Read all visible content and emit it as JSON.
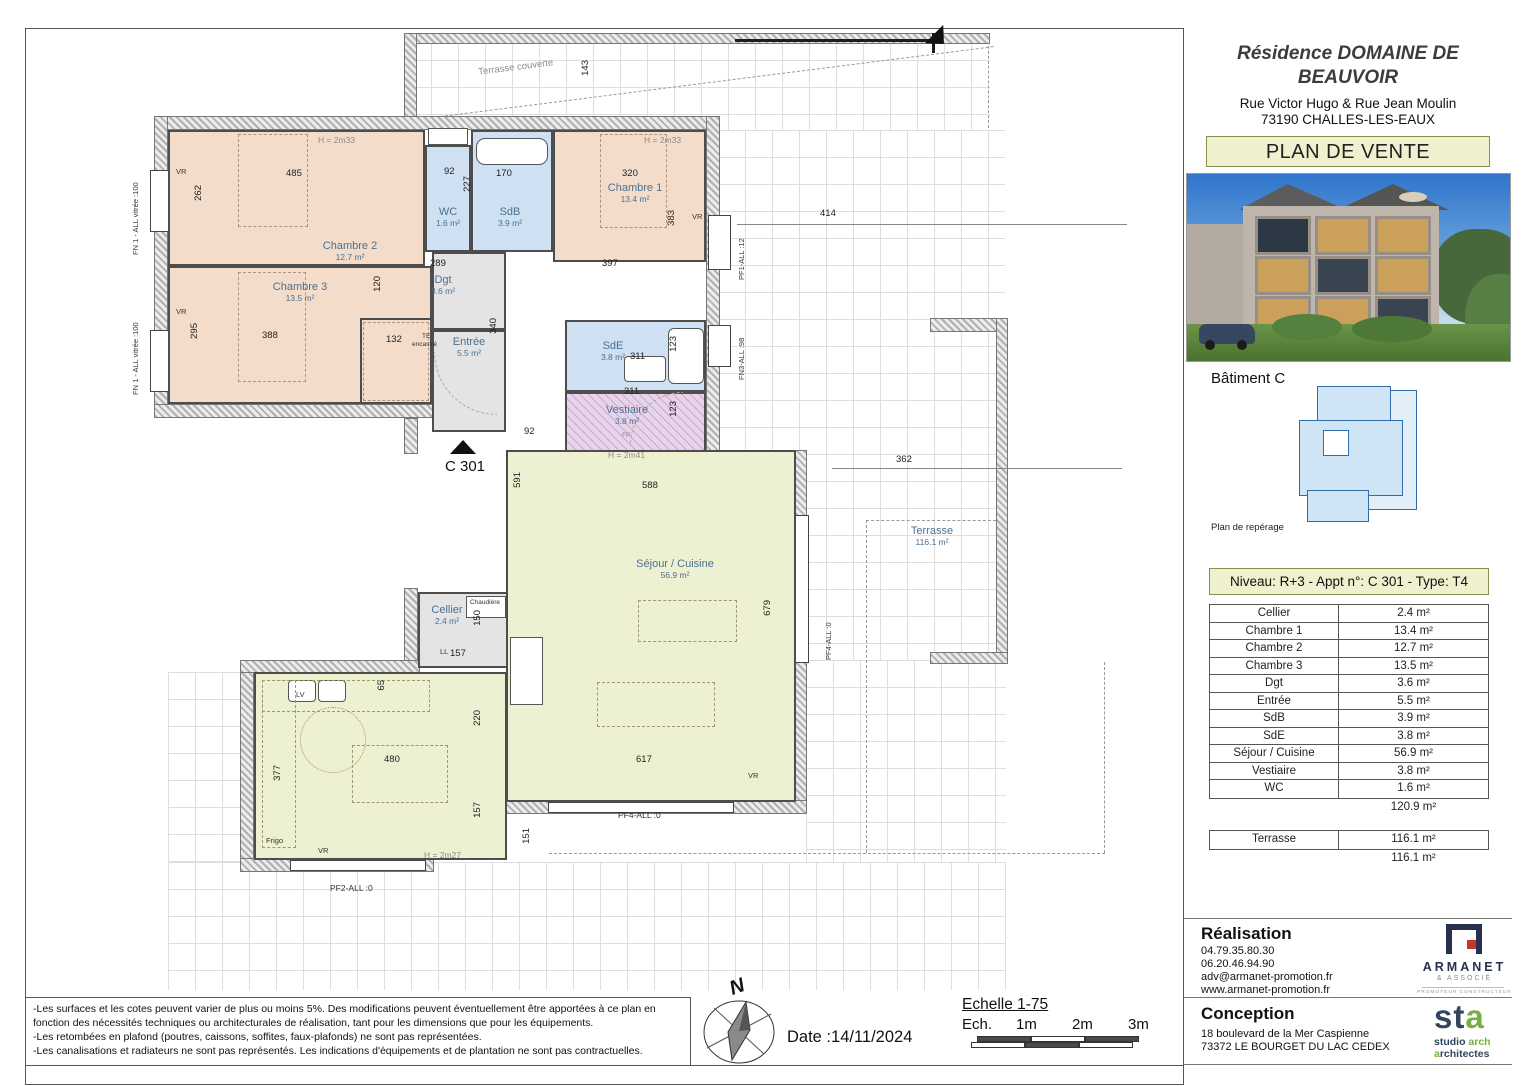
{
  "title_block": {
    "title_line1": "Résidence DOMAINE DE",
    "title_line2": "BEAUVOIR",
    "address_line1": "Rue Victor Hugo & Rue Jean Moulin",
    "address_line2": "73190 CHALLES-LES-EAUX",
    "plan_de_vente": "PLAN DE VENTE"
  },
  "reperage": {
    "batiment": "Bâtiment C",
    "caption": "Plan de repérage"
  },
  "apartment_table": {
    "header": "Niveau: R+3  - Appt n°: C 301 - Type: T4",
    "rows": [
      {
        "label": "Cellier",
        "value": "2.4 m²"
      },
      {
        "label": "Chambre 1",
        "value": "13.4 m²"
      },
      {
        "label": "Chambre 2",
        "value": "12.7 m²"
      },
      {
        "label": "Chambre 3",
        "value": "13.5 m²"
      },
      {
        "label": "Dgt",
        "value": "3.6 m²"
      },
      {
        "label": "Entrée",
        "value": "5.5 m²"
      },
      {
        "label": "SdB",
        "value": "3.9 m²"
      },
      {
        "label": "SdE",
        "value": "3.8 m²"
      },
      {
        "label": "Séjour / Cuisine",
        "value": "56.9 m²"
      },
      {
        "label": "Vestiaire",
        "value": "3.8 m²"
      },
      {
        "label": "WC",
        "value": "1.6 m²"
      }
    ],
    "subtotal": "120.9 m²",
    "terrasse_label": "Terrasse",
    "terrasse_value": "116.1 m²",
    "terrasse_total": "116.1 m²"
  },
  "realisation": {
    "heading": "Réalisation",
    "phone1": "04.79.35.80.30",
    "phone2": "06.20.46.94.90",
    "email": "adv@armanet-promotion.fr",
    "website": "www.armanet-promotion.fr"
  },
  "conception": {
    "heading": "Conception",
    "address1": "18 boulevard de la Mer Caspienne",
    "address2": "73372 LE BOURGET DU LAC CEDEX"
  },
  "armanet_logo": {
    "name": "ARMANET",
    "sub": "& ASSOCIÉ",
    "tagline": "PROMOTEUR CONSTRUCTEUR"
  },
  "sta_logo": {
    "mark_st": "st",
    "mark_a": "a",
    "line1_a": "studio ",
    "line1_b": "arch",
    "line2_a": "a",
    "line2_b": "rchitectes"
  },
  "footer": {
    "disclaimer": [
      "-Les surfaces et les cotes peuvent varier de plus ou moins 5%. Des modifications peuvent éventuellement être apportées à ce plan en fonction des nécessités techniques ou architecturales de réalisation, tant pour les dimensions que pour les équipements.",
      "-Les retombées en plafond (poutres, caissons, soffites, faux-plafonds) ne sont pas représentées.",
      "-Les canalisations et radiateurs ne sont pas représentés. Les indications d'équipements et de plantation ne sont pas contractuelles."
    ],
    "date_label": "Date :14/11/2024",
    "scale_title": "Echelle 1-75",
    "scale_ech": "Ech.",
    "scale_1m": "1m",
    "scale_2m": "2m",
    "scale_3m": "3m",
    "north_letter": "N"
  },
  "plan": {
    "apartment_id": "C 301",
    "rooms": {
      "ch2": {
        "name": "Chambre 2",
        "area": "12.7 m²"
      },
      "ch1": {
        "name": "Chambre 1",
        "area": "13.4 m²"
      },
      "ch3": {
        "name": "Chambre 3",
        "area": "13.5 m²"
      },
      "wc": {
        "name": "WC",
        "area": "1.6 m²"
      },
      "sdb": {
        "name": "SdB",
        "area": "3.9 m²"
      },
      "dgt": {
        "name": "Dgt",
        "area": "3.6 m²"
      },
      "entree": {
        "name": "Entrée",
        "area": "5.5 m²"
      },
      "sde": {
        "name": "SdE",
        "area": "3.8 m²"
      },
      "vestiaire": {
        "name": "Vestiaire",
        "area": "3.8 m²"
      },
      "sejour": {
        "name": "Séjour / Cuisine",
        "area": "56.9 m²"
      },
      "cellier": {
        "name": "Cellier",
        "area": "2.4 m²"
      },
      "terrasse": {
        "name": "Terrasse",
        "area": "116.1 m²"
      },
      "terrasse_couverte": {
        "name": "Terrasse couverte"
      }
    },
    "dims": {
      "ch2_width": "485",
      "ch2_left": "262",
      "wc_width": "92",
      "wc_height": "227",
      "sdb_width": "170",
      "ch1_width": "320",
      "ch1_right": "383",
      "ch1_bottom": "397",
      "terrace_top_right": "414",
      "dgt_width": "289",
      "dgt_left": "120",
      "ch3_width": "388",
      "ch3_left": "295",
      "ch3_closet": "132",
      "entree_height": "340",
      "sde_width": "311",
      "sde_right": "123",
      "vest_width": "311",
      "vest_right": "123",
      "entree_bottom": "92",
      "sejour_left": "591",
      "sejour_top": "588",
      "sejour_right": "679",
      "terrace_right_top": "362",
      "cellier_right": "150",
      "cellier_bottom": "157",
      "kitchen_sink": "65",
      "kitchen_door": "220",
      "kitchen_width": "480",
      "kitchen_left": "377",
      "kitchen_right": "157",
      "terrace_bottom_left": "151",
      "sejour_bottom": "617",
      "terrace_strip": "143"
    },
    "heights": {
      "ch2": "H = 2m33",
      "ch1": "H = 2m33",
      "sejour": "H = 2m41",
      "kitchen": "H = 2m27"
    },
    "tags": {
      "vr": "VR",
      "fn1": "FN 1 - ALL vitrée :100",
      "pf1": "PF1-ALL :12",
      "fn3": "FN3-ALL :98",
      "pf4": "PF4-ALL :0",
      "pf2": "PF2-ALL :0",
      "te": "TE",
      "te2": "encastré",
      "ll": "LL",
      "lv": "LV",
      "frigo": "Frigo",
      "chaudiere": "Chaudière",
      "fp": "FP"
    }
  },
  "colors": {
    "bedroom": "#f4dcca",
    "bathroom": "#cfe0f2",
    "hall": "#e4e4e4",
    "living": "#eef0d2",
    "vestiaire": "#e7d4ea",
    "accent_box": "#eef0ce",
    "room_label": "#4b7191",
    "armanet_navy": "#27314f",
    "armanet_red": "#c0392b",
    "sta_green": "#76b043",
    "sta_navy": "#33455c"
  }
}
